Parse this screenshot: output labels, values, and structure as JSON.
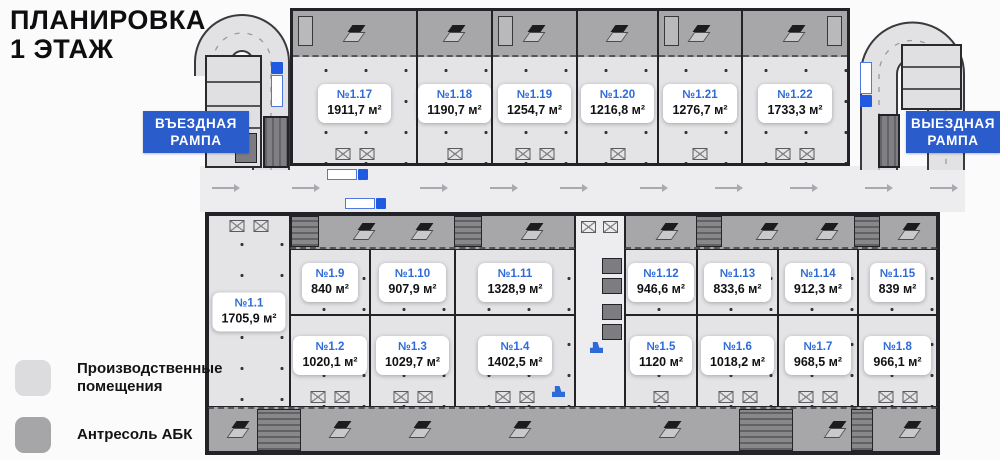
{
  "header": {
    "title_line1": "ПЛАНИРОВКА",
    "title_line2": "1 ЭТАЖ"
  },
  "ramps": {
    "entry": {
      "line1": "ВЪЕЗДНАЯ",
      "line2": "РАМПА"
    },
    "exit": {
      "line1": "ВЫЕЗДНАЯ",
      "line2": "РАМПА"
    }
  },
  "legend": {
    "items": [
      {
        "label": "Производственные\nпомещения",
        "swatch_color": "#dcdcdf"
      },
      {
        "label": "Антресоль АБК",
        "swatch_color": "#a6a6a9"
      }
    ]
  },
  "units": {
    "top": [
      {
        "id": "№1.17",
        "area": "1911,7 м²"
      },
      {
        "id": "№1.18",
        "area": "1190,7 м²"
      },
      {
        "id": "№1.19",
        "area": "1254,7 м²"
      },
      {
        "id": "№1.20",
        "area": "1216,8 м²"
      },
      {
        "id": "№1.21",
        "area": "1276,7 м²"
      },
      {
        "id": "№1.22",
        "area": "1733,3 м²"
      }
    ],
    "left": {
      "id": "№1.1",
      "area": "1705,9 м²"
    },
    "middle": [
      {
        "id": "№1.9",
        "area": "840 м²"
      },
      {
        "id": "№1.10",
        "area": "907,9 м²"
      },
      {
        "id": "№1.11",
        "area": "1328,9 м²"
      },
      {
        "id": "№1.12",
        "area": "946,6 м²"
      },
      {
        "id": "№1.13",
        "area": "833,6 м²"
      },
      {
        "id": "№1.14",
        "area": "912,3 м²"
      },
      {
        "id": "№1.15",
        "area": "839 м²"
      }
    ],
    "bottom": [
      {
        "id": "№1.2",
        "area": "1020,1 м²"
      },
      {
        "id": "№1.3",
        "area": "1029,7 м²"
      },
      {
        "id": "№1.4",
        "area": "1402,5 м²"
      },
      {
        "id": "№1.5",
        "area": "1120 м²"
      },
      {
        "id": "№1.6",
        "area": "1018,2 м²"
      },
      {
        "id": "№1.7",
        "area": "968,5 м²"
      },
      {
        "id": "№1.8",
        "area": "966,1 м²"
      }
    ]
  },
  "colors": {
    "ramp_label_blue": "#2b5ccb",
    "unit_number_blue": "#2f6bd8",
    "production_fill": "#e4e4e6",
    "mezzanine_fill": "#a7a7aa",
    "wall": "#232327"
  }
}
